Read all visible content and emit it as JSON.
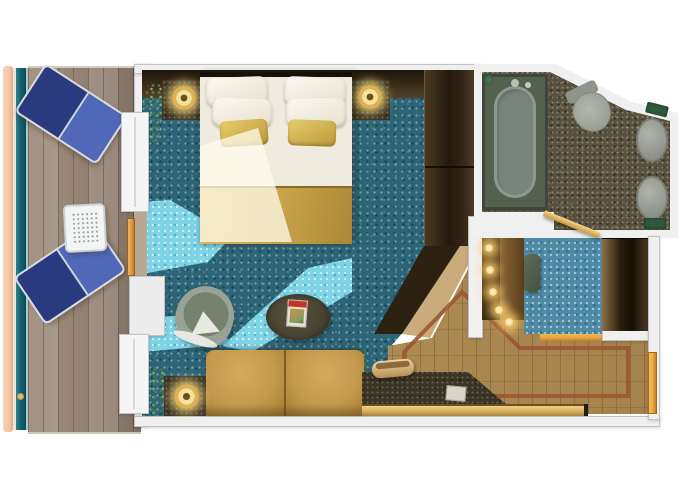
{
  "title": "cruise-ship-balcony-stateroom-floor-plan-rendering",
  "colors": {
    "bg": "#ffffff",
    "wall": "#f0f0f0",
    "wall-edge": "#c3c3c3",
    "hull-peach": "#f4c5a5",
    "railing-teal": "#17616f",
    "deck-base": "#a29080",
    "carpet-base": "#2e6576",
    "carpet-entry": "#4f8aa4",
    "sun-cyan": "#7ed3e6",
    "granite-base": "#57513d",
    "wood-base": "#b08c50",
    "inlay-red": "#9c5533",
    "counter-dark": "#3a3424",
    "wardrobe-dark": "#241a0c",
    "wardrobe-mid": "#4a3920",
    "beige-angle": "#cdae7e",
    "duvet-white": "#f0ebdf",
    "runner-gold": "#c8a44a",
    "sofa-tan": "#c49a4e",
    "chair-sage": "#76816e",
    "chair-rim": "#99a294",
    "table-dark": "#46412f",
    "tub-surround": "#55614f",
    "tub-fill": "#79857c",
    "fixture-grey": "#a0a39b",
    "accent-green": "#2f5a3e",
    "door-orange": "#e8a83e",
    "lounger-navy": "#2a3a7e",
    "lounger-royal": "#4f68b8",
    "plant-dark": "#4c7a42",
    "plant-light": "#8fae6f",
    "drawer-gold": "#d9b563",
    "magazine-red": "#c23526"
  },
  "rooms": [
    {
      "name": "balcony",
      "floor": "teak-deck"
    },
    {
      "name": "bedroom-living-area",
      "floor": "teal-mosaic-carpet"
    },
    {
      "name": "bathroom",
      "floor": "dark-granite"
    },
    {
      "name": "dressing-corridor",
      "floor": "blue-mosaic-carpet"
    },
    {
      "name": "entry-hall",
      "floor": "wood-with-inlay-border"
    }
  ],
  "furniture": {
    "balcony": [
      "lounge-chair",
      "lounge-chair",
      "mesh-side-table"
    ],
    "bedroom": [
      "king-bed",
      "white-pillows-x4",
      "gold-accent-pillows-x2",
      "gold-bed-runner",
      "nightstand-left",
      "nightstand-right",
      "gold-lamp-x2",
      "wardrobe-wall",
      "plant-x2"
    ],
    "living": [
      "tub-armchair",
      "oval-coffee-table",
      "magazine",
      "leather-sofa",
      "side-table",
      "gold-lamp",
      "desk-counter",
      "telephone",
      "note-card",
      "gold-drawer-front"
    ],
    "bathroom": [
      "bathtub",
      "toilet",
      "sink",
      "sink",
      "green-towel-x2"
    ],
    "dressing-corridor": [
      "lighted-vanity",
      "vanity-stool",
      "wardrobe-closet"
    ],
    "doors": [
      "balcony-sliding-door",
      "bathroom-door-open",
      "cabin-entry-door"
    ]
  }
}
